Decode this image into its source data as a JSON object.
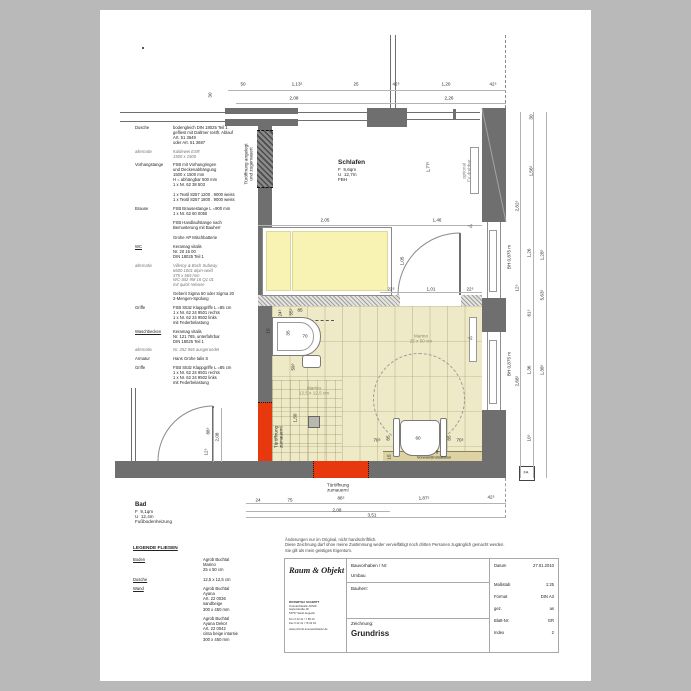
{
  "colors": {
    "wall": "#6f6f6f",
    "red": "#e8380d",
    "bath_floor": "#eee9c6",
    "strip": "#ddd2a2",
    "bed": "#f8f3b2",
    "paper": "#ffffff",
    "background": "#b9b9b9"
  },
  "rooms": {
    "schlafen": {
      "name": "Schlafen",
      "area": "F  9,6qm",
      "perimeter": "U  12,7m",
      "note": "FBH"
    },
    "bad": {
      "name": "Bad",
      "area": "F  9,1qm",
      "perimeter": "U  12,4m",
      "note": "Fußbodenheizung"
    }
  },
  "spec": {
    "sections": [
      {
        "label": "Dusche",
        "lines": [
          "bodengleich DIN 18025 Teil 1",
          "gefliest mit Dallmer rostfr. Ablauf",
          "Art. 51 3649",
          "oder Art. 51 3687"
        ]
      },
      {
        "label": "alternativ",
        "italic": true,
        "lines": [
          "Kaldewei ESR",
          "1500 x 1500"
        ]
      },
      {
        "label": "Vorhangstange",
        "lines": [
          "FSB mit Vorhangringen",
          "und Deckenabhängung",
          "1500 x 1500 mm",
          "H = abhängbar 500 mm",
          "1 x Nr. 62 38 503",
          "",
          "1 x Textil 8257 1200 . 9000 weiss",
          "1 x Textil 8257 1800 . 9000 weiss"
        ]
      },
      {
        "label": "Brause",
        "lines": [
          "FSB Brausestange L =900 mm",
          "1 x Nr. 62 60 0050",
          "",
          "FSB Handlaufstange nach",
          "Bemusterung mit Bauherr",
          "",
          "Grohe AP Mischbatterie"
        ]
      },
      {
        "label": "WC",
        "underline": true,
        "lines": [
          "Keramag vitalis",
          "Nr. 20 15 00",
          "DIN 18025 Teil 1"
        ]
      },
      {
        "label": "alternativ",
        "italic": true,
        "lines": [
          "Villeroy & Boch Subway",
          "6600 1001 alpin-weiß",
          "375 x 565 mm",
          "WC-Sitz 9M 16 Q1 01",
          "mit quick release"
        ]
      },
      {
        "label": "",
        "lines": [
          "Geberit Sigma 50 oder Sigma 20",
          "2-Mengen-Spülung"
        ]
      },
      {
        "label": "Griffe",
        "lines": [
          "FSB Stütz Klappgriffe L =85 cm",
          "1 x Nr. 62 24 9501 rechts",
          "1 x Nr. 62 24 9502 links",
          "mit Federbelastung"
        ]
      },
      {
        "label": "Waschbecken",
        "underline": true,
        "lines": [
          "Keramag vitalis",
          "Nr. 121 765, unterfahrbar",
          "DIN 18025 Teil 1"
        ]
      },
      {
        "label": "alternativ",
        "italic": true,
        "lines": [
          "Nr. 252 065 ausgerundet"
        ]
      },
      {
        "label": "Armatur",
        "lines": [
          "Hans Grohe talis S"
        ]
      },
      {
        "label": "Griffe",
        "lines": [
          "FSB Stütz Klappgriffe L =85 cm",
          "1 x Nr. 62 24 9501 rechts",
          "1 x Nr. 62 24 9502 links",
          "mit Federbelastung"
        ]
      }
    ]
  },
  "dims": [
    {
      "t": "50",
      "x": 243,
      "y": 84
    },
    {
      "t": "1,13⁵",
      "x": 297,
      "y": 84
    },
    {
      "t": "25",
      "x": 356,
      "y": 84
    },
    {
      "t": "42⁵",
      "x": 396,
      "y": 84
    },
    {
      "t": "1,20",
      "x": 446,
      "y": 84
    },
    {
      "t": "42⁵",
      "x": 493,
      "y": 84
    },
    {
      "t": "2,08",
      "x": 294,
      "y": 98
    },
    {
      "t": "2,26",
      "x": 449,
      "y": 98
    },
    {
      "t": "30",
      "x": 210,
      "y": 95,
      "r": -90
    },
    {
      "t": "2,05",
      "x": 325,
      "y": 220
    },
    {
      "t": "1,46",
      "x": 437,
      "y": 220
    },
    {
      "t": "1,77⁵",
      "x": 428,
      "y": 167,
      "r": -90
    },
    {
      "t": "1,05",
      "x": 402,
      "y": 261,
      "r": -90
    },
    {
      "t": "22⁵",
      "x": 391,
      "y": 289
    },
    {
      "t": "1,01",
      "x": 431,
      "y": 289
    },
    {
      "t": "22⁵",
      "x": 470,
      "y": 289
    },
    {
      "t": "~2",
      "x": 470,
      "y": 226
    },
    {
      "t": "30",
      "x": 531,
      "y": 117,
      "r": -90
    },
    {
      "t": "1,56⁵",
      "x": 531,
      "y": 171,
      "r": -90
    },
    {
      "t": "2,82⁵",
      "x": 517,
      "y": 206,
      "r": -90
    },
    {
      "t": "BH 0,875 m",
      "x": 509,
      "y": 257,
      "r": -90
    },
    {
      "t": "1,26",
      "x": 529,
      "y": 253,
      "r": -90
    },
    {
      "t": "1,28⁵",
      "x": 542,
      "y": 255,
      "r": -90
    },
    {
      "t": "12⁵",
      "x": 517,
      "y": 288,
      "r": -90
    },
    {
      "t": "5,63⁵",
      "x": 542,
      "y": 295,
      "r": -90
    },
    {
      "t": "61⁵",
      "x": 529,
      "y": 313,
      "r": -90
    },
    {
      "t": "BH 0,875 m",
      "x": 509,
      "y": 364,
      "r": -90
    },
    {
      "t": "2,68⁵",
      "x": 517,
      "y": 381,
      "r": -90
    },
    {
      "t": "1,36",
      "x": 529,
      "y": 370,
      "r": -90
    },
    {
      "t": "1,38⁵",
      "x": 542,
      "y": 370,
      "r": -90
    },
    {
      "t": "10⁵",
      "x": 529,
      "y": 438,
      "r": -90
    },
    {
      "t": "24⁵",
      "x": 280,
      "y": 313,
      "r": -90
    },
    {
      "t": "55⁵",
      "x": 291,
      "y": 312,
      "r": -90
    },
    {
      "t": "85",
      "x": 300,
      "y": 310
    },
    {
      "t": "15",
      "x": 268,
      "y": 331,
      "r": -90
    },
    {
      "t": "35",
      "x": 288,
      "y": 333,
      "r": -90
    },
    {
      "t": "70",
      "x": 305,
      "y": 336
    },
    {
      "t": "59⁵",
      "x": 293,
      "y": 367,
      "r": -90
    },
    {
      "t": "1,50",
      "x": 295,
      "y": 418,
      "r": -90
    },
    {
      "t": "~2",
      "x": 470,
      "y": 338
    },
    {
      "t": "70⁵",
      "x": 377,
      "y": 440
    },
    {
      "t": "85",
      "x": 388,
      "y": 438,
      "r": -90
    },
    {
      "t": "60",
      "x": 418,
      "y": 438
    },
    {
      "t": "85",
      "x": 449,
      "y": 438,
      "r": -90
    },
    {
      "t": "70⁵",
      "x": 460,
      "y": 440
    },
    {
      "t": "8",
      "x": 437,
      "y": 452
    },
    {
      "t": "15",
      "x": 389,
      "y": 457,
      "r": -90
    },
    {
      "t": "88⁵",
      "x": 208,
      "y": 431,
      "r": -90
    },
    {
      "t": "2,08",
      "x": 217,
      "y": 437,
      "r": -90
    },
    {
      "t": "12⁵",
      "x": 206,
      "y": 452,
      "r": -90
    },
    {
      "t": "24",
      "x": 258,
      "y": 500
    },
    {
      "t": "75",
      "x": 290,
      "y": 500
    },
    {
      "t": "88⁵",
      "x": 341,
      "y": 498
    },
    {
      "t": "1,87⁵",
      "x": 424,
      "y": 498
    },
    {
      "t": "42⁵",
      "x": 491,
      "y": 497
    },
    {
      "t": "2,08",
      "x": 337,
      "y": 510
    },
    {
      "t": "3,51",
      "x": 372,
      "y": 515
    }
  ],
  "notes": [
    {
      "t": "Türöffnung angelegt\nund zugemauert",
      "x": 249,
      "y": 164,
      "r": -90
    },
    {
      "t": "optional\nTV drehbar",
      "x": 467,
      "y": 171,
      "r": -90,
      "c": "#858585"
    },
    {
      "t": "Türöffnung\nzumauern!",
      "x": 279,
      "y": 437,
      "r": -90
    },
    {
      "t": "Türöffnung\nzumauern!",
      "x": 338,
      "y": 488
    },
    {
      "t": "Marino\n25 x 50 cm",
      "x": 421,
      "y": 339,
      "c": "#8d8868"
    },
    {
      "t": "Marino\n12,5 x 12,5 cm",
      "x": 314,
      "y": 391,
      "c": "#8d8868"
    },
    {
      "t": "Vorwandinstallation",
      "x": 434,
      "y": 457,
      "fs": 4
    },
    {
      "t": "FA",
      "x": 526,
      "y": 472,
      "fs": 4
    }
  ],
  "legend": {
    "title": "LEGENDE FLIESEN",
    "rows": [
      {
        "label": "Boden",
        "lines": [
          "Agrob Buchtal",
          "Marino",
          "25 x 50 cm"
        ]
      },
      {
        "label": "Dusche",
        "lines": [
          "12,5 x 12,5 cm"
        ]
      },
      {
        "label": "Wand",
        "lines": [
          "Agrob Buchtal",
          "Ayana",
          "Art. 22 0036",
          "sandbeige",
          "300 x 450 mm"
        ]
      },
      {
        "label": "",
        "lines": [
          "Agrob Buchtal",
          "Ayana Dekor",
          "Art. 22 0042",
          "cinta beige intarsie",
          "300 x 450 mm"
        ]
      }
    ]
  },
  "disclaimer": [
    "Änderungen nur im Original, nicht handschriftlich.",
    "Diese Zeichnung darf ohne meine Zustimmung weder vervielfältigt noch dritten Personen zugänglich gemacht werden.",
    "Sie gilt als mein geistiges Eigentum."
  ],
  "titleblock": {
    "logo": "Raum & Objekt",
    "firm": [
      "ROSWITHA SCHMITT",
      "Innenarchitektin AKNW",
      "Gartenstraße 48",
      "53757 Sankt Augustin",
      "Fon 0 22 41 / 7 89 10",
      "Fax 0 22 41 / 79 34 03",
      "www.schmitt-innenarchitektur.de"
    ],
    "project_label": "Bauvorhaben / Nr:",
    "project_value": "Umbau",
    "client_label": "Bauherr:",
    "drawing_label": "Zeichnung:",
    "drawing_value": "Grundriss",
    "fields": [
      {
        "label": "Datum",
        "value": "27.01.2010"
      },
      {
        "label": "Maßstab",
        "value": "1:25"
      },
      {
        "label": "Format",
        "value": "DIN A3"
      },
      {
        "label": "gez.",
        "value": "as"
      },
      {
        "label": "Blatt-Nr:",
        "value": "GR"
      },
      {
        "label": "Index",
        "value": "2"
      }
    ]
  }
}
